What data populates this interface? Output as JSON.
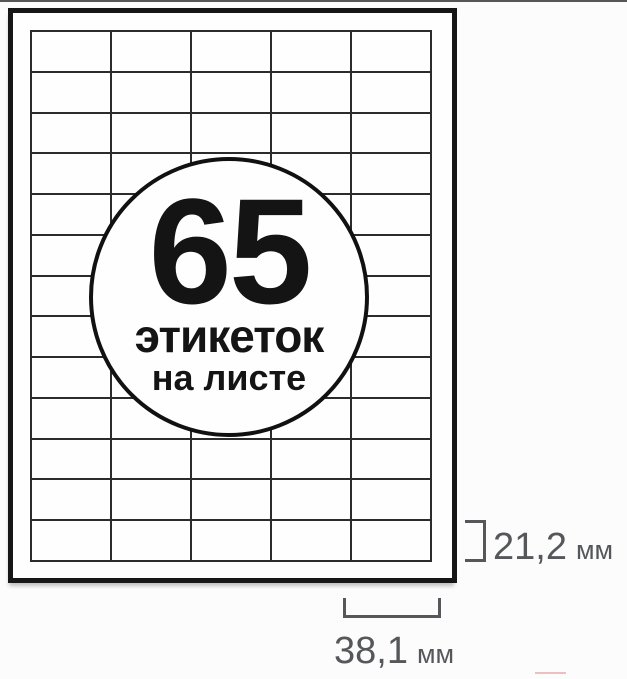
{
  "badge": {
    "count": "65",
    "caption_line1": "этикеток",
    "caption_line2": "на листе"
  },
  "grid": {
    "rows": 13,
    "columns": 5,
    "total_labels": 65
  },
  "annotations": {
    "label_height": {
      "value": "21,2",
      "unit": "мм"
    },
    "label_width": {
      "value": "38,1",
      "unit": "мм"
    }
  },
  "colors": {
    "annotation_text": "#56575b",
    "grid_line": "#2b2b2b",
    "sheet_border": "#161616",
    "badge_border": "#111111",
    "background": "#fcfcfc"
  }
}
